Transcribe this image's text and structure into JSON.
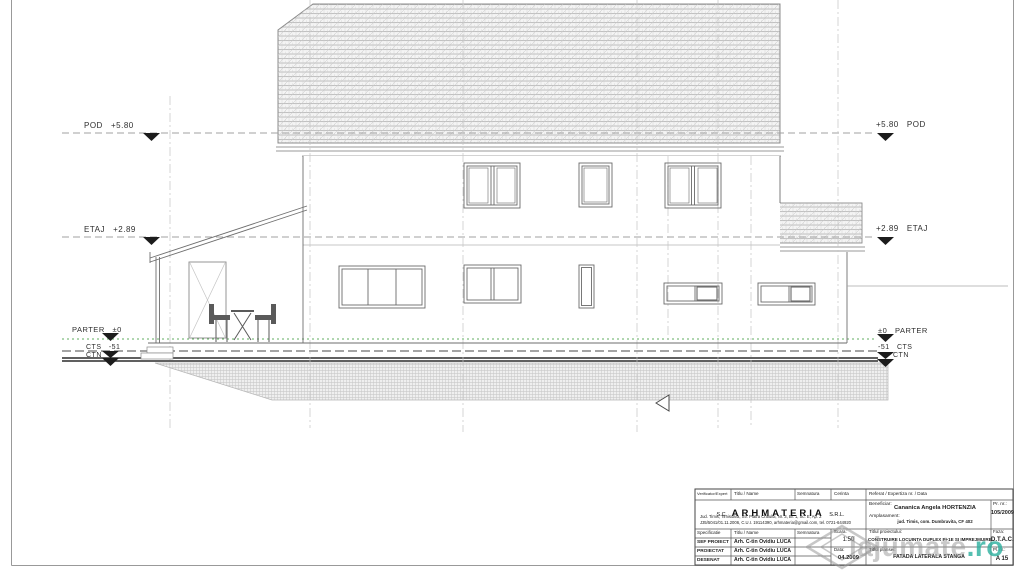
{
  "levels": {
    "left": [
      "POD   +5.80",
      "ETAJ   +2.89",
      "PARTER   ±0",
      "CTS   -51",
      "CTN"
    ],
    "right": [
      "+5.80   POD",
      "+2.89   ETAJ",
      "±0   PARTER",
      "-51   CTS",
      "CTN"
    ]
  },
  "title_block": {
    "header": {
      "verificator": "Verificator/Expert",
      "titlu_name": "Titlu / Name",
      "semnatura": "Semnatura",
      "cerinta": "Cerinta",
      "referat": "Referat / Expertiza nr. / Data"
    },
    "company": {
      "prefix": "S.C.",
      "name": "ARHMATERIA",
      "suffix": "S.R.L.",
      "address_line1": "Jud. Timis, Timisoara, Str. Piatra Craiului, Nr. 3, Bl. 1, Sc. E, Ap. 2",
      "address_line2": "J35/5041/01.11.2006, C.U.I. 19114390, arhmateria@gmail.com, tel. 0721-644920"
    },
    "beneficiar_label": "Beneficiar:",
    "beneficiar": "Cananica Angela HORTENZIA",
    "amplasament_label": "Amplasament:",
    "amplasament": "jud. Timis, com. Dumbravita, CF 402",
    "pr_nr_label": "Pr. nr.:",
    "pr_nr": "105/2009",
    "spec_header": {
      "specificatie": "Specificatie",
      "titlu_name": "Titlu / Name",
      "semnatura": "Semnatura"
    },
    "rows": [
      {
        "spec": "SEF PROIECT",
        "name": "Arh. C-tin Ovidiu LUCA"
      },
      {
        "spec": "PROIECTAT",
        "name": "Arh. C-tin Ovidiu LUCA"
      },
      {
        "spec": "DESENAT",
        "name": "Arh. C-tin Ovidiu LUCA"
      }
    ],
    "scara_label": "Scara:",
    "scara": "1:50",
    "data_label": "Data:",
    "data": "04.2009",
    "proiect_label": "Titlul proiectului:",
    "proiect": "CONSTRUIRE LOCUINTA DUPLEX P+1E SI IMPREJMUIRE",
    "faza_label": "Faza:",
    "faza": "D.T.A.C.",
    "plansa_label": "Titlul plansei:",
    "plansa": "FATADA LATERALA STANGA",
    "pl_nr_label": "Pl. nr.:",
    "pl_nr": "A 15"
  },
  "watermark": {
    "gray": "lajumate",
    "teal": ".ro"
  },
  "colors": {
    "watermark_teal": "#2aaf9d",
    "parter_level_green": "#5fae5f",
    "line_gray": "#6e6e6e",
    "hatch_gray": "#c0c0c0"
  }
}
